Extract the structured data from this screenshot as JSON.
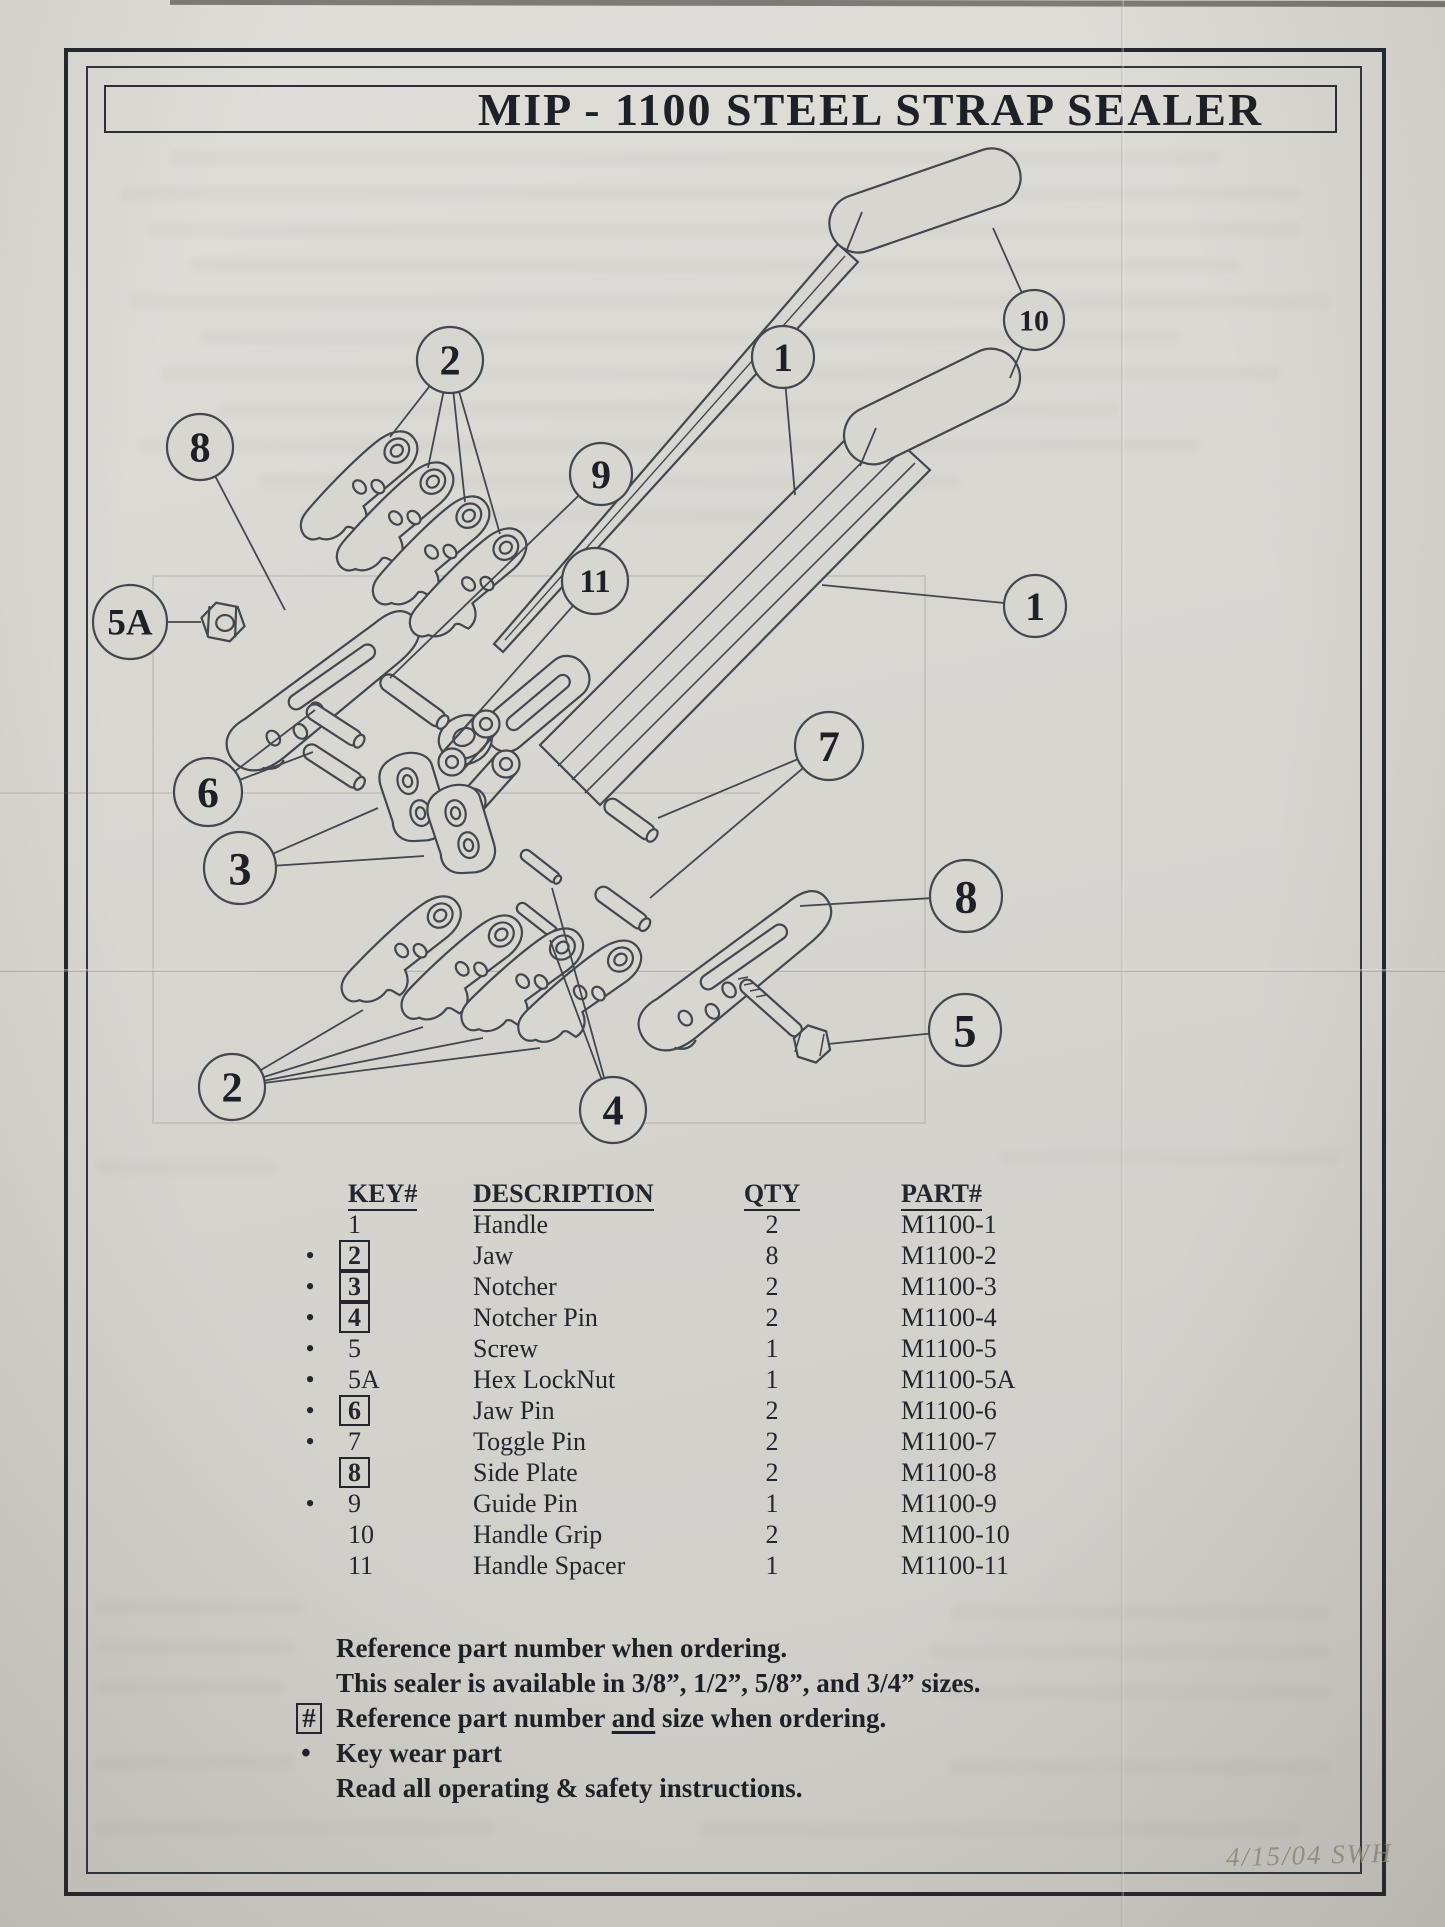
{
  "page": {
    "title": "MIP - 1100 STEEL STRAP SEALER",
    "date_note": "4/15/04 SWH"
  },
  "diagram": {
    "callouts": [
      {
        "label": "2",
        "x": 450,
        "y": 360,
        "r": 33,
        "to": [
          [
            390,
            437
          ],
          [
            428,
            468
          ],
          [
            465,
            502
          ],
          [
            500,
            534
          ]
        ]
      },
      {
        "label": "8",
        "x": 200,
        "y": 447,
        "r": 33,
        "to": [
          [
            285,
            610
          ]
        ]
      },
      {
        "label": "9",
        "x": 601,
        "y": 474,
        "r": 31,
        "to": [
          [
            390,
            678
          ]
        ]
      },
      {
        "label": "1",
        "x": 783,
        "y": 357,
        "r": 31,
        "to": [
          [
            795,
            495
          ]
        ]
      },
      {
        "label": "10",
        "x": 1034,
        "y": 320,
        "r": 30,
        "to": [
          [
            993,
            228
          ],
          [
            1010,
            378
          ]
        ]
      },
      {
        "label": "11",
        "x": 595,
        "y": 581,
        "r": 33,
        "to": [
          [
            470,
            722
          ]
        ]
      },
      {
        "label": "5A",
        "x": 130,
        "y": 622,
        "r": 37,
        "to": [
          [
            201,
            622
          ]
        ]
      },
      {
        "label": "1",
        "x": 1035,
        "y": 606,
        "r": 31,
        "to": [
          [
            822,
            585
          ]
        ]
      },
      {
        "label": "6",
        "x": 208,
        "y": 792,
        "r": 34,
        "to": [
          [
            315,
            710
          ],
          [
            313,
            752
          ]
        ]
      },
      {
        "label": "3",
        "x": 240,
        "y": 868,
        "r": 36,
        "to": [
          [
            378,
            808
          ],
          [
            424,
            856
          ]
        ]
      },
      {
        "label": "7",
        "x": 829,
        "y": 746,
        "r": 34,
        "to": [
          [
            658,
            818
          ],
          [
            650,
            898
          ]
        ]
      },
      {
        "label": "8",
        "x": 966,
        "y": 896,
        "r": 36,
        "to": [
          [
            800,
            906
          ]
        ]
      },
      {
        "label": "5",
        "x": 965,
        "y": 1030,
        "r": 36,
        "to": [
          [
            828,
            1044
          ]
        ]
      },
      {
        "label": "2",
        "x": 232,
        "y": 1087,
        "r": 33,
        "to": [
          [
            363,
            1010
          ],
          [
            423,
            1027
          ],
          [
            483,
            1038
          ],
          [
            540,
            1048
          ]
        ]
      },
      {
        "label": "4",
        "x": 613,
        "y": 1110,
        "r": 33,
        "to": [
          [
            552,
            888
          ],
          [
            550,
            940
          ]
        ]
      }
    ]
  },
  "parts_table": {
    "headers": [
      "KEY#",
      "DESCRIPTION",
      "QTY",
      "PART#"
    ],
    "rows": [
      {
        "bullet": false,
        "boxed": false,
        "key": "1",
        "desc": "Handle",
        "qty": "2",
        "part": "M1100-1"
      },
      {
        "bullet": true,
        "boxed": true,
        "key": "2",
        "desc": "Jaw",
        "qty": "8",
        "part": "M1100-2"
      },
      {
        "bullet": true,
        "boxed": true,
        "key": "3",
        "desc": "Notcher",
        "qty": "2",
        "part": "M1100-3"
      },
      {
        "bullet": true,
        "boxed": true,
        "key": "4",
        "desc": "Notcher Pin",
        "qty": "2",
        "part": "M1100-4"
      },
      {
        "bullet": true,
        "boxed": false,
        "key": "5",
        "desc": "Screw",
        "qty": "1",
        "part": "M1100-5"
      },
      {
        "bullet": true,
        "boxed": false,
        "key": "5A",
        "desc": "Hex LockNut",
        "qty": "1",
        "part": "M1100-5A"
      },
      {
        "bullet": true,
        "boxed": true,
        "key": "6",
        "desc": "Jaw Pin",
        "qty": "2",
        "part": "M1100-6"
      },
      {
        "bullet": true,
        "boxed": false,
        "key": "7",
        "desc": "Toggle Pin",
        "qty": "2",
        "part": "M1100-7"
      },
      {
        "bullet": false,
        "boxed": true,
        "key": "8",
        "desc": "Side Plate",
        "qty": "2",
        "part": "M1100-8"
      },
      {
        "bullet": true,
        "boxed": false,
        "key": "9",
        "desc": "Guide Pin",
        "qty": "1",
        "part": "M1100-9"
      },
      {
        "bullet": false,
        "boxed": false,
        "key": "10",
        "desc": "Handle Grip",
        "qty": "2",
        "part": "M1100-10"
      },
      {
        "bullet": false,
        "boxed": false,
        "key": "11",
        "desc": "Handle Spacer",
        "qty": "1",
        "part": "M1100-11"
      }
    ]
  },
  "notes": [
    {
      "marker": "",
      "pre": "Reference part number when ordering.",
      "u": "",
      "post": ""
    },
    {
      "marker": "",
      "pre": "This sealer is available in 3/8”, 1/2”, 5/8”, and 3/4” sizes.",
      "u": "",
      "post": ""
    },
    {
      "marker": "#",
      "pre": "Reference part number ",
      "u": "and",
      "post": " size when ordering."
    },
    {
      "marker": "•",
      "pre": "Key wear part",
      "u": "",
      "post": ""
    },
    {
      "marker": "",
      "pre": "Read all operating & safety instructions.",
      "u": "",
      "post": ""
    }
  ],
  "colors": {
    "paper": "#d8d6d1",
    "ink": "#23262c",
    "line": "#43474e"
  }
}
